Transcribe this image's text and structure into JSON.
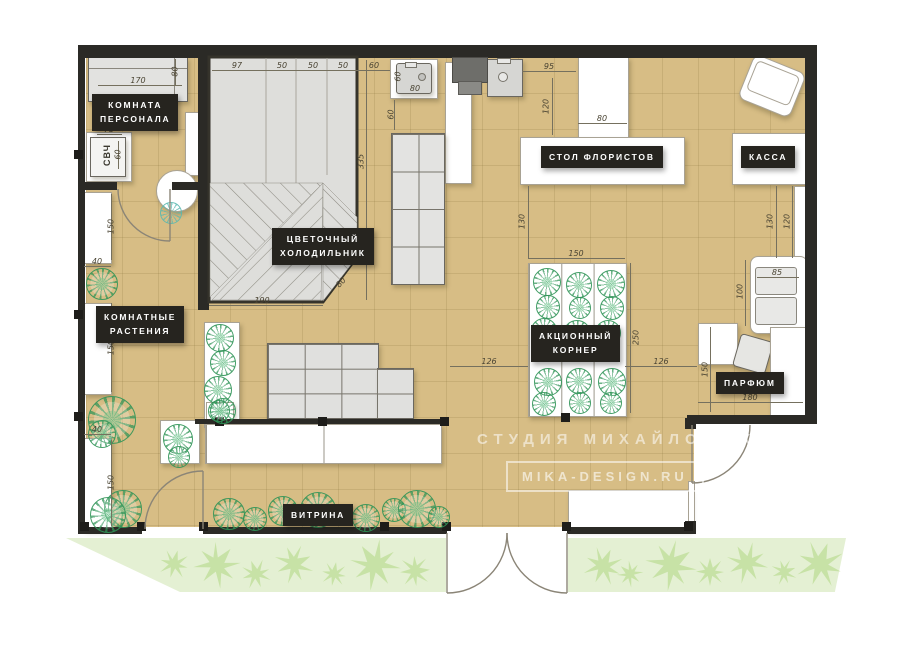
{
  "colors": {
    "floor": "#d7bd85",
    "wall": "#2b2a26",
    "plant_green": "#2f9457",
    "outside_green": "#e4f0d3",
    "badge_bg": "#26241f"
  },
  "labels": {
    "staff_room": "КОМНАТА\nПЕРСОНАЛА",
    "microwave": "СВЧ",
    "flower_fridge": "ЦВЕТОЧНЫЙ\nХОЛОДИЛЬНИК",
    "indoor_plants": "КОМНАТНЫЕ\nРАСТЕНИЯ",
    "florist_table": "СТОЛ ФЛОРИСТОВ",
    "cash_desk": "КАССА",
    "promo_corner": "АКЦИОННЫЙ\nКОРНЕР",
    "perfume": "ПАРФЮМ",
    "showcase": "ВИТРИНА"
  },
  "watermark": {
    "studio": "СТУДИЯ МИХАЙЛОВЫХ",
    "site": "MIKA-DESIGN.RU"
  },
  "dims": {
    "top_97": "97",
    "top_50a": "50",
    "top_50b": "50",
    "top_50c": "50",
    "top_60": "60",
    "sink_w": "80",
    "sink_h": "60",
    "below_sink": "60",
    "fridge_h": "335",
    "fridge_w": "190",
    "fridge_diag": "80",
    "sink2_gap": "95",
    "sink2_down": "120",
    "stem_w": "80",
    "florist_gap": "130",
    "cash_a": "130",
    "cash_b": "120",
    "sofa_h": "100",
    "sofa_w": "85",
    "corner_w": "150",
    "corner_h": "250",
    "corner_left": "126",
    "corner_right": "126",
    "perfume_h": "150",
    "perfume_w": "180",
    "staff_sofa_w": "170",
    "staff_sofa_d": "80",
    "micro_w": "75",
    "micro_d": "60",
    "shelf_w_mid": "40",
    "shelf_w_bot": "40",
    "left_top": "150",
    "left_mid": "150",
    "left_bot": "150"
  }
}
